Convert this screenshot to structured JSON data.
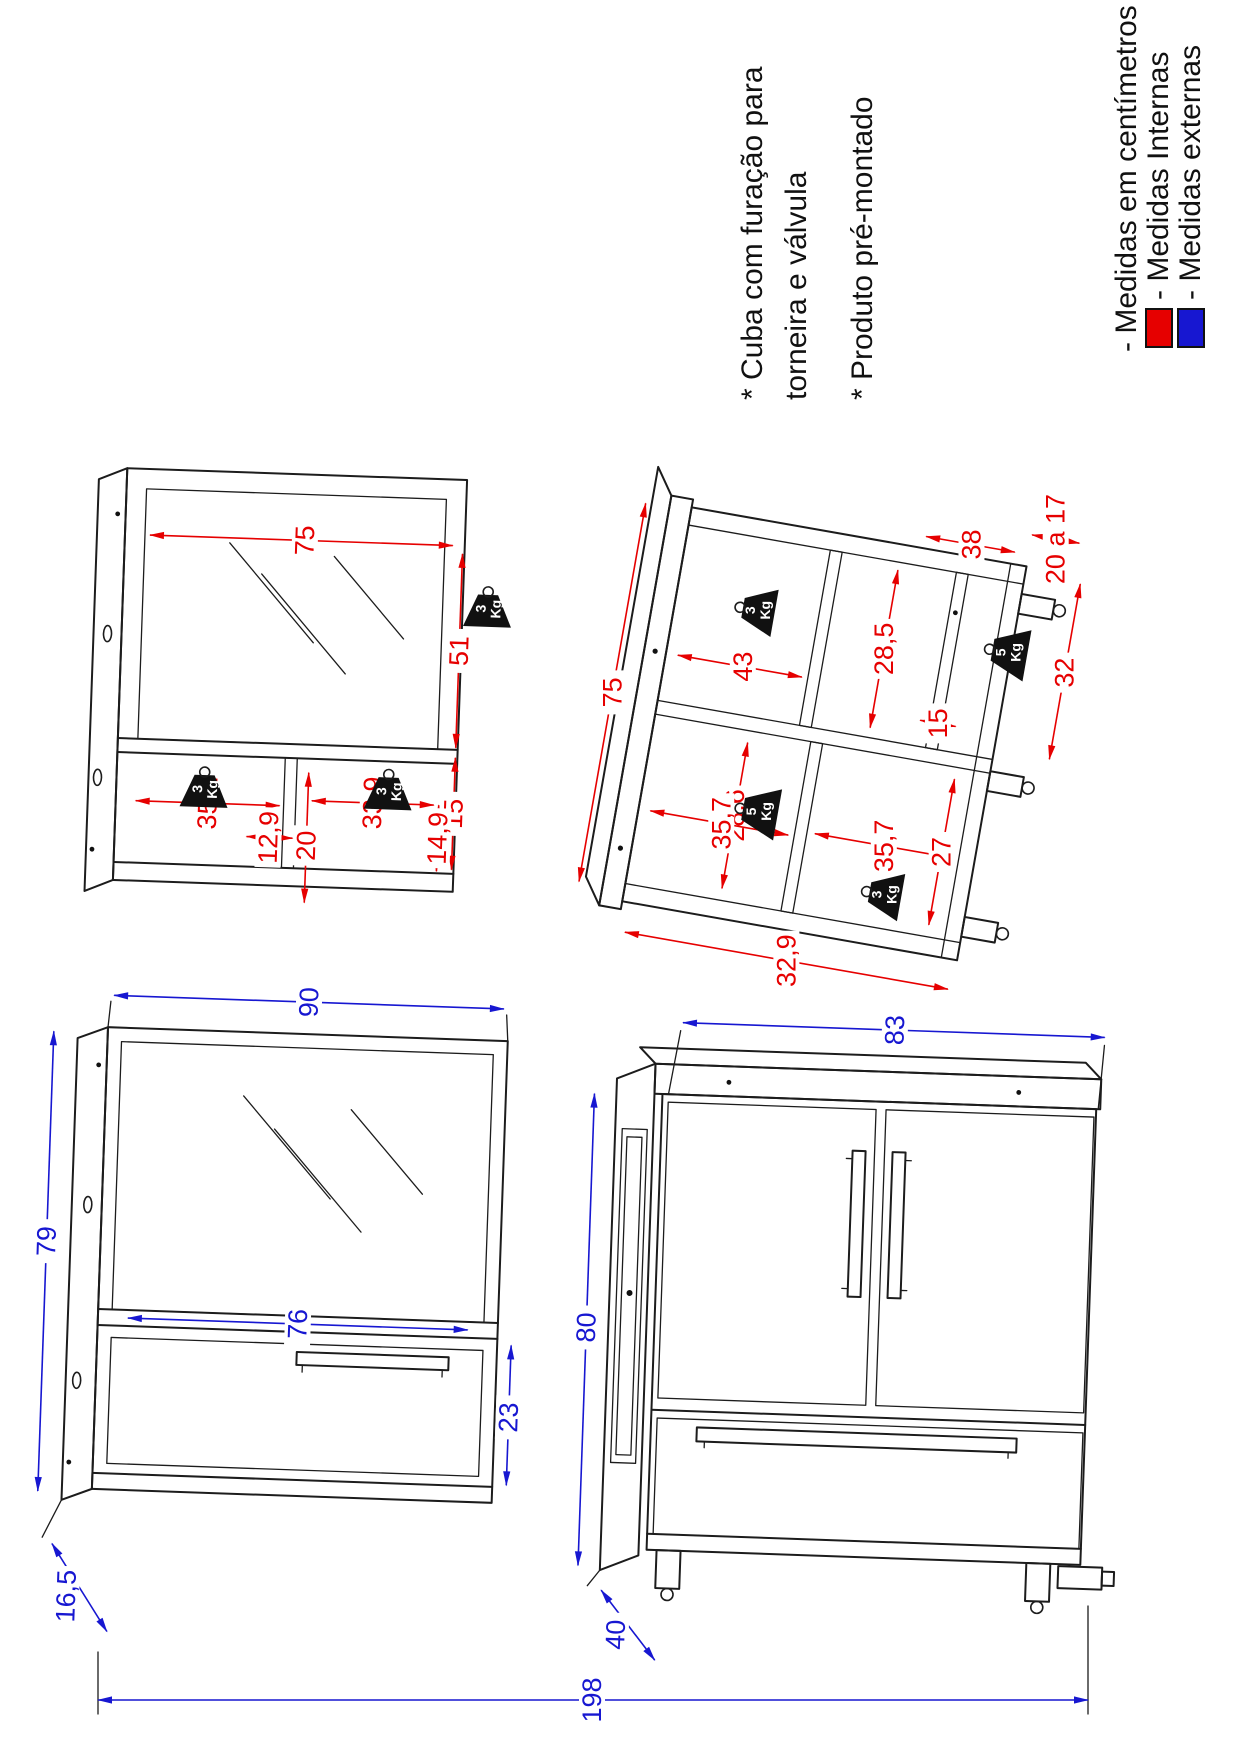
{
  "page": {
    "background": "#ffffff"
  },
  "notes": {
    "line1": "* Cuba com furação para",
    "line2": "torneira e válvula",
    "line3": "* Produto pré-montado"
  },
  "legend": {
    "units_label": "- Medidas em centímetros",
    "internal_label": "- Medidas Internas",
    "external_label": "- Medidas externas",
    "internal_color": "#e60000",
    "external_color": "#1717d1"
  },
  "weight_badges": {
    "three": "3",
    "five": "5",
    "unit": "Kg"
  },
  "mirror_internal": {
    "width": "75",
    "mirror_height": "51",
    "shelf_height": "15",
    "left_compartment_width": "35,1",
    "divider_width": "12,9",
    "shelf_depth": "20",
    "right_compartment_width": "33,9",
    "right_divider_depth": "14,9"
  },
  "cabinet_internal": {
    "width": "75",
    "side_depth": "32,9",
    "top_compartment_width": "28,6",
    "upper_depth": "35,7",
    "lower_depth": "35,7",
    "right_compartment_height": "43",
    "shelf_gap": "15",
    "right_compartment_width": "28,5",
    "bottom_left_width": "27",
    "bottom_right_width": "32",
    "bottom_depth": "38",
    "foot_height_range": "20 a 17"
  },
  "mirror_external": {
    "width": "90",
    "height": "79",
    "shelf_width": "76",
    "door_height": "23",
    "depth": "16,5"
  },
  "cabinet_external": {
    "width": "83",
    "height": "80",
    "depth": "40"
  },
  "total": {
    "height": "198"
  }
}
